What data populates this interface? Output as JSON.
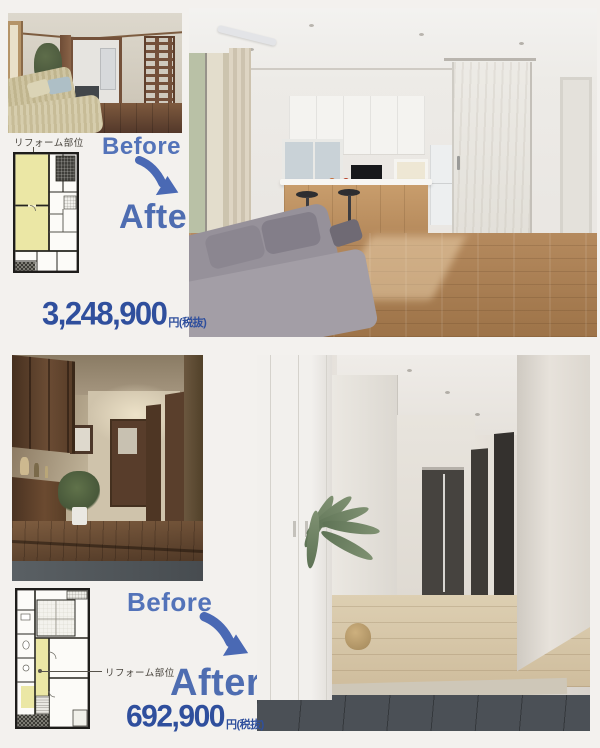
{
  "page": {
    "background_color": "#f3f1ee"
  },
  "colors": {
    "label_blue": "#5373b9",
    "arrow_blue": "#4a69b4",
    "price_blue": "#2f4f9d",
    "plan_highlight_yellow": "#ebe7a5"
  },
  "icons": {
    "curved_arrow": "curved-arrow-down-right-icon"
  },
  "sections": [
    {
      "reform_area_label": "リフォーム部位",
      "before_label": "Before",
      "after_label": "After",
      "price_amount": "3,248,900",
      "price_suffix": "円(税抜)"
    },
    {
      "reform_area_label": "リフォーム部位",
      "before_label": "Before",
      "after_label": "After",
      "price_amount": "692,900",
      "price_suffix": "円(税抜)"
    }
  ]
}
